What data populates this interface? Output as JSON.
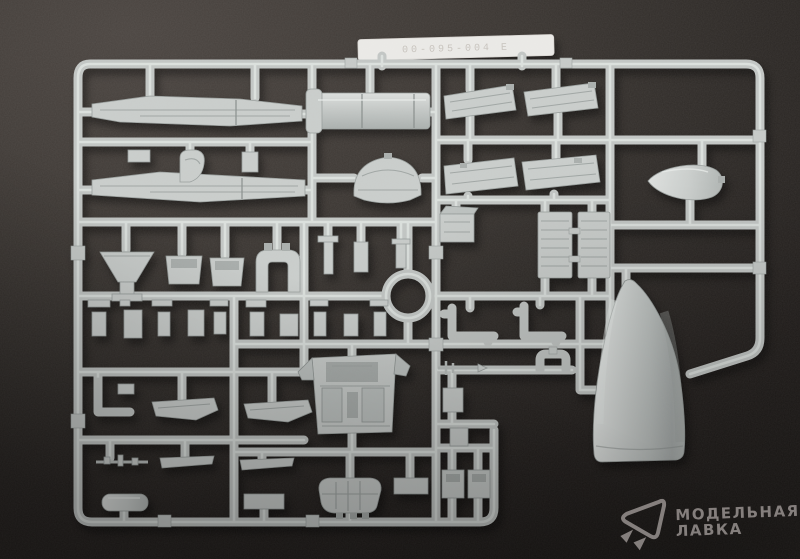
{
  "photo": {
    "sprue_tab": {
      "label_text": "00-095-004 E"
    },
    "watermark": {
      "line1": "МОДЕЛЬНАЯ",
      "line2": "ЛАВКА",
      "logo_icon": "paper-sail-logo-icon"
    },
    "colors": {
      "background_light": "#4b4541",
      "background_dark": "#1b1816",
      "plastic_light": "#e8ebe9",
      "plastic_mid": "#c2c6c4",
      "plastic_shadow": "#8f9593",
      "label_tab": "#ebeae7",
      "watermark_gray": "#8e8886"
    }
  }
}
